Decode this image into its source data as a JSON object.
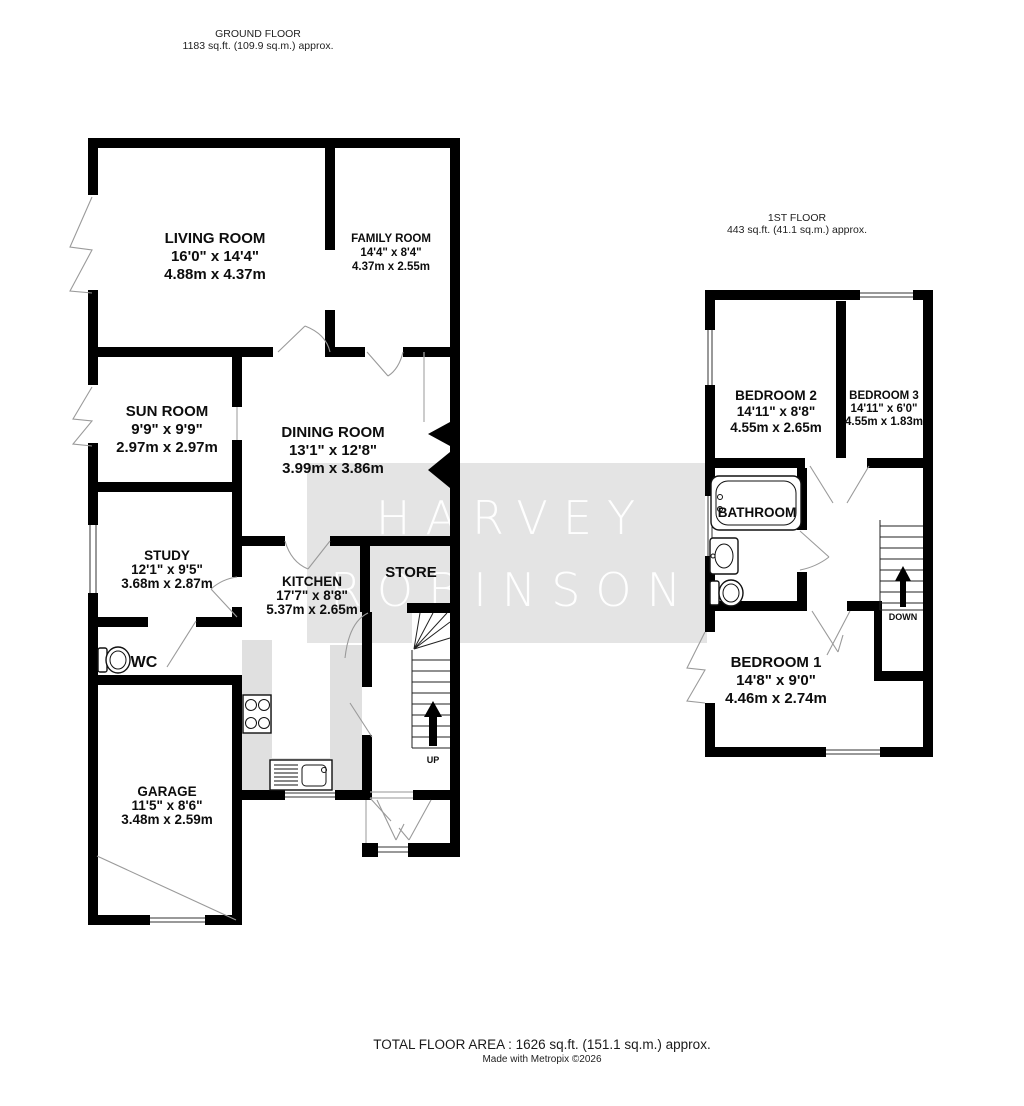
{
  "ground_floor": {
    "title": "GROUND FLOOR",
    "area": "1183 sq.ft. (109.9 sq.m.) approx.",
    "rooms": {
      "living": {
        "name": "LIVING ROOM",
        "imperial": "16'0\" x 14'4\"",
        "metric": "4.88m x 4.37m"
      },
      "family": {
        "name": "FAMILY ROOM",
        "imperial": "14'4\" x 8'4\"",
        "metric": "4.37m x 2.55m"
      },
      "sun": {
        "name": "SUN ROOM",
        "imperial": "9'9\" x 9'9\"",
        "metric": "2.97m x 2.97m"
      },
      "dining": {
        "name": "DINING ROOM",
        "imperial": "13'1\" x 12'8\"",
        "metric": "3.99m x 3.86m"
      },
      "study": {
        "name": "STUDY",
        "imperial": "12'1\" x 9'5\"",
        "metric": "3.68m x 2.87m"
      },
      "kitchen": {
        "name": "KITCHEN",
        "imperial": "17'7\" x 8'8\"",
        "metric": "5.37m x 2.65m"
      },
      "store": {
        "name": "STORE"
      },
      "wc": {
        "name": "WC"
      },
      "garage": {
        "name": "GARAGE",
        "imperial": "11'5\" x 8'6\"",
        "metric": "3.48m x 2.59m"
      }
    },
    "stairs_label": "UP"
  },
  "first_floor": {
    "title": "1ST FLOOR",
    "area": "443 sq.ft. (41.1 sq.m.) approx.",
    "rooms": {
      "bedroom2": {
        "name": "BEDROOM 2",
        "imperial": "14'11\" x 8'8\"",
        "metric": "4.55m x 2.65m"
      },
      "bedroom3": {
        "name": "BEDROOM 3",
        "imperial": "14'11\" x 6'0\"",
        "metric": "4.55m x 1.83m"
      },
      "bathroom": {
        "name": "BATHROOM"
      },
      "bedroom1": {
        "name": "BEDROOM 1",
        "imperial": "14'8\" x 9'0\"",
        "metric": "4.46m x 2.74m"
      }
    },
    "stairs_label": "DOWN"
  },
  "watermark": {
    "line1": "HARVEY",
    "line2": "ROBINSON"
  },
  "footer": {
    "total_area": "TOTAL FLOOR AREA : 1626 sq.ft. (151.1 sq.m.) approx.",
    "credit": "Made with Metropix ©2026"
  },
  "colors": {
    "wall": "#000000",
    "counter": "#e0e0e0",
    "watermark_band_overlay": "rgba(0,0,0,0.105)",
    "watermark_text": "#ffffff"
  }
}
